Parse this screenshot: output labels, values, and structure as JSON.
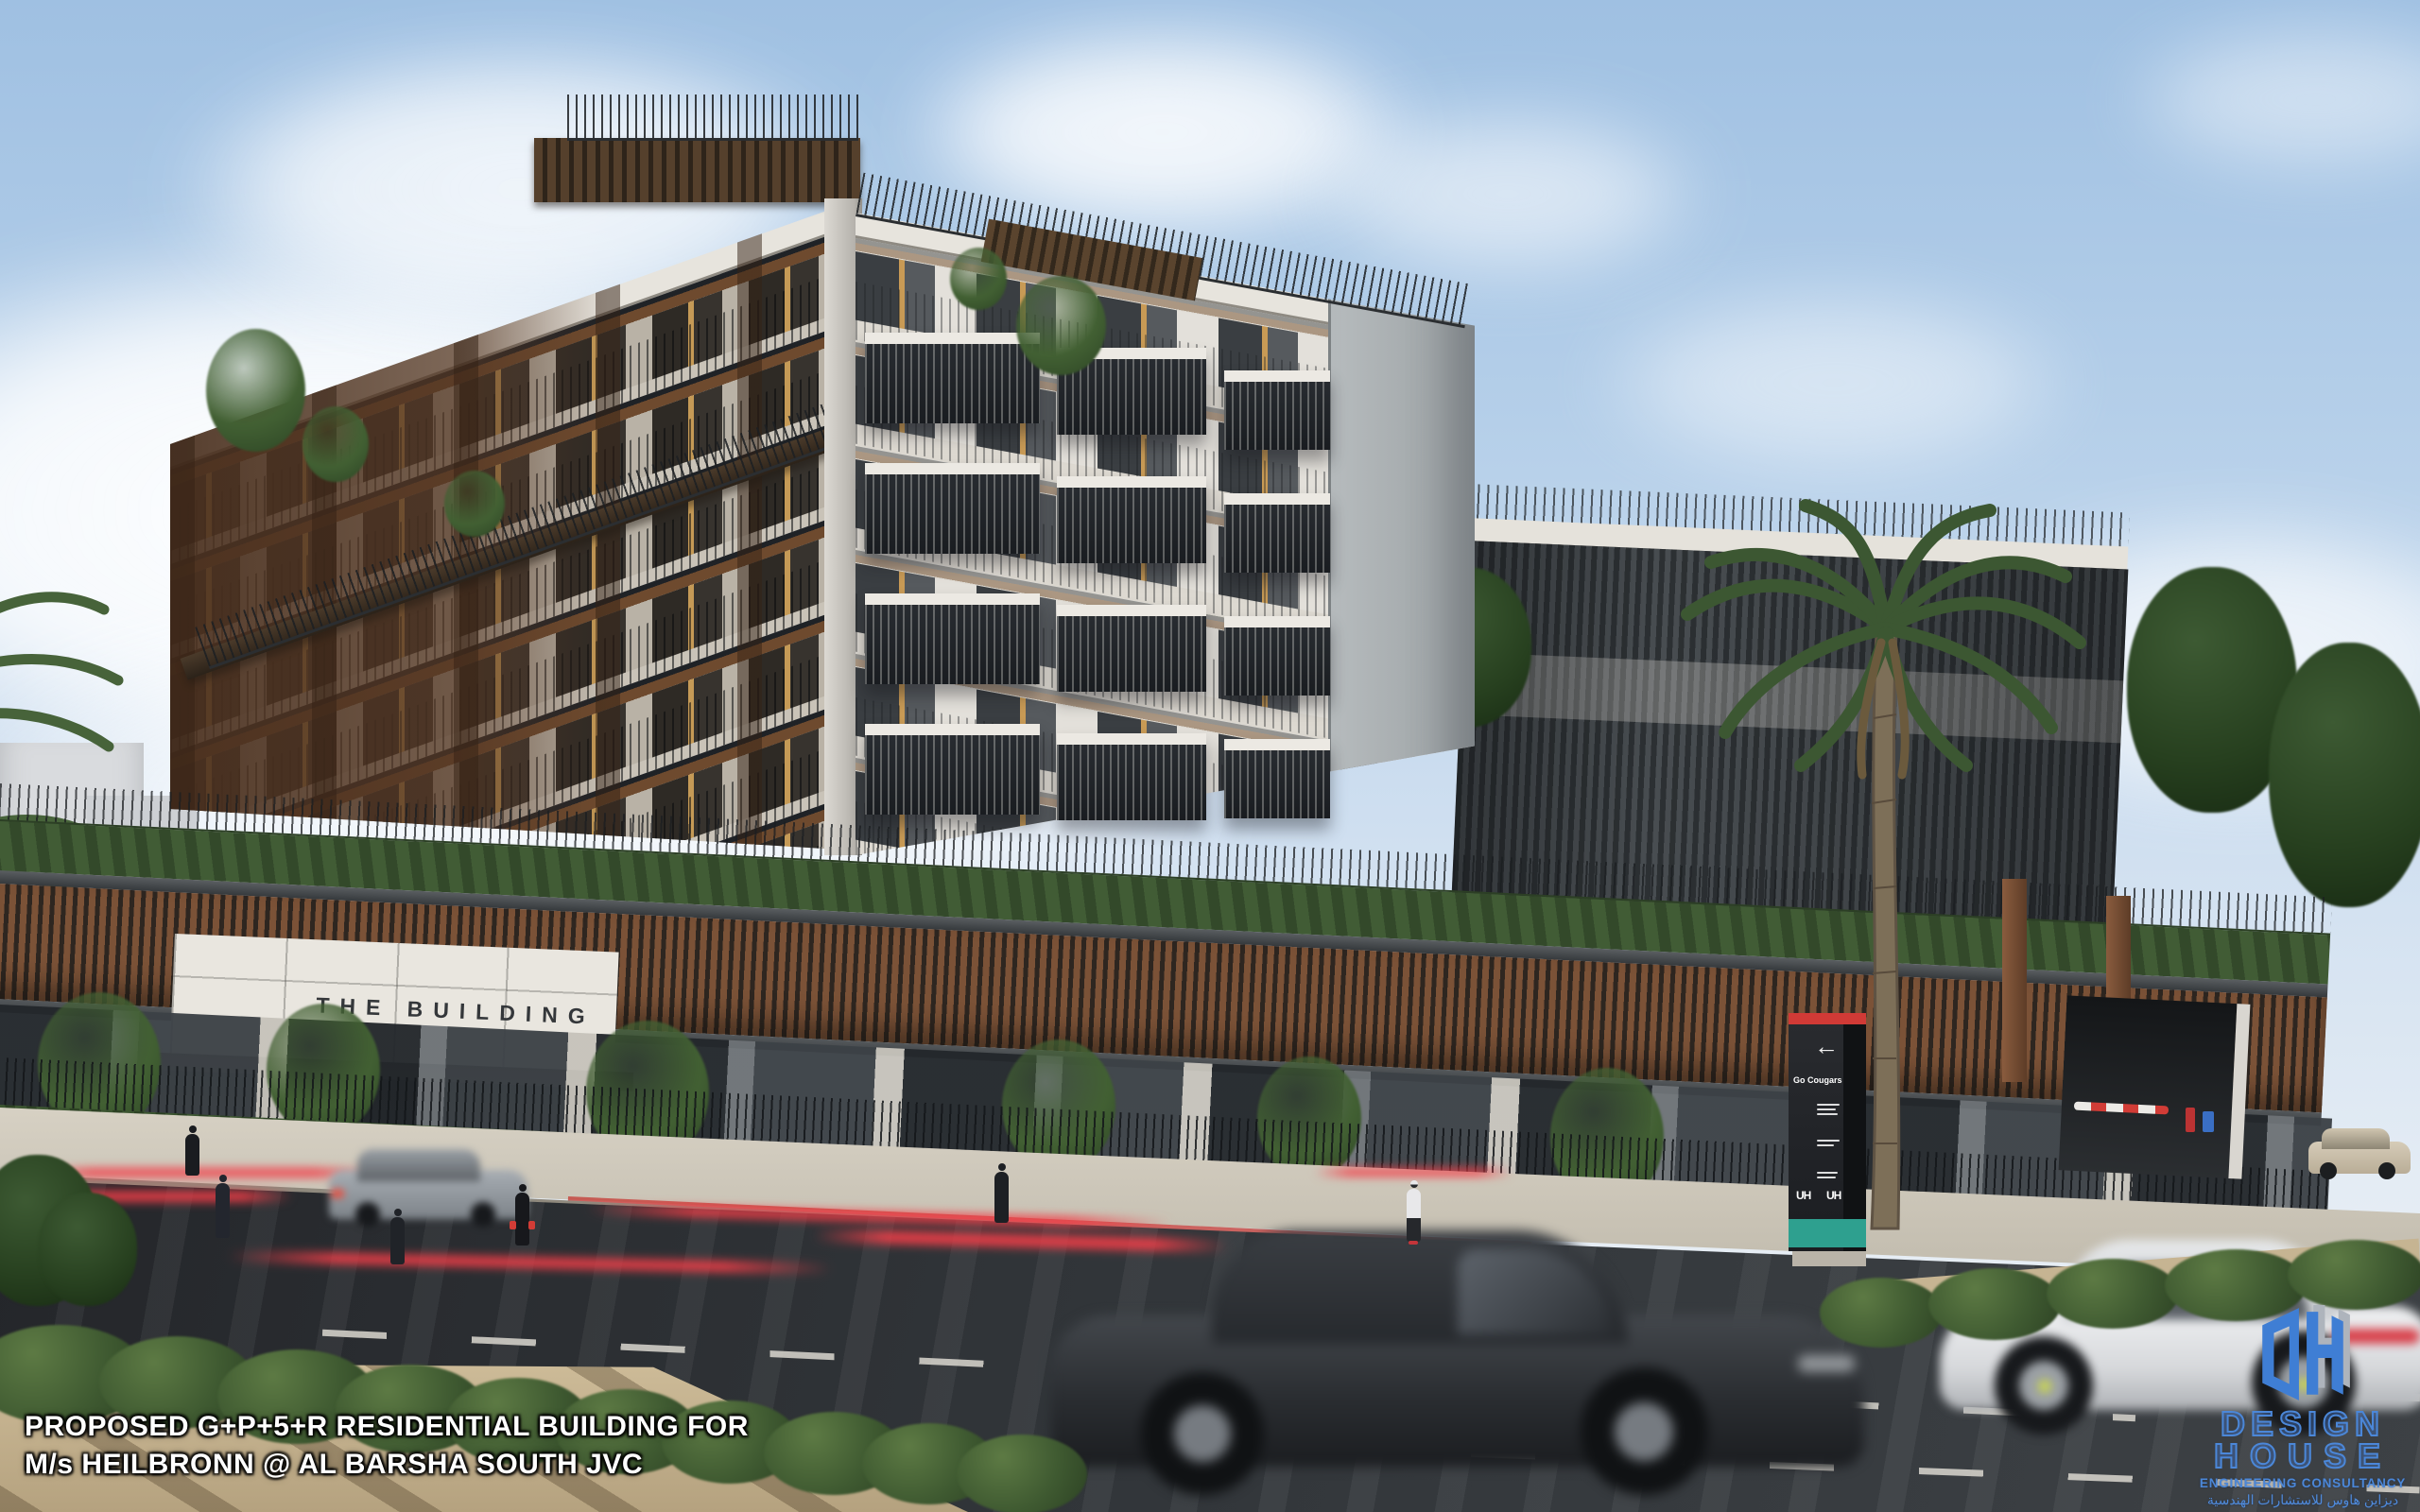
{
  "scene": {
    "type": "architectural exterior rendering, street-level perspective",
    "sky_color": "#a9c6e4",
    "wood_color": "#7b5237",
    "hedge_color": "#46603a",
    "road_color": "#2b2e31",
    "accent_red": "#d23c36",
    "accent_teal": "#2ea08f"
  },
  "building": {
    "sign_text": "THE BUILDING"
  },
  "pylon": {
    "arrow": "←",
    "headline": "Go Cougars",
    "logo_left": "UH",
    "logo_right": "UH"
  },
  "overlay": {
    "line1": "PROPOSED G+P+5+R RESIDENTIAL BUILDING FOR",
    "line2": "M/s HEILBRONN @ AL BARSHA SOUTH  JVC"
  },
  "logo": {
    "monogram": "DH",
    "word1": "DESIGN",
    "word2": "HOUSE",
    "tagline": "ENGINEERING CONSULTANCY",
    "arabic": "ديزاين هاوس للاستشارات الهندسية",
    "brand_color": "#4b87d8"
  }
}
